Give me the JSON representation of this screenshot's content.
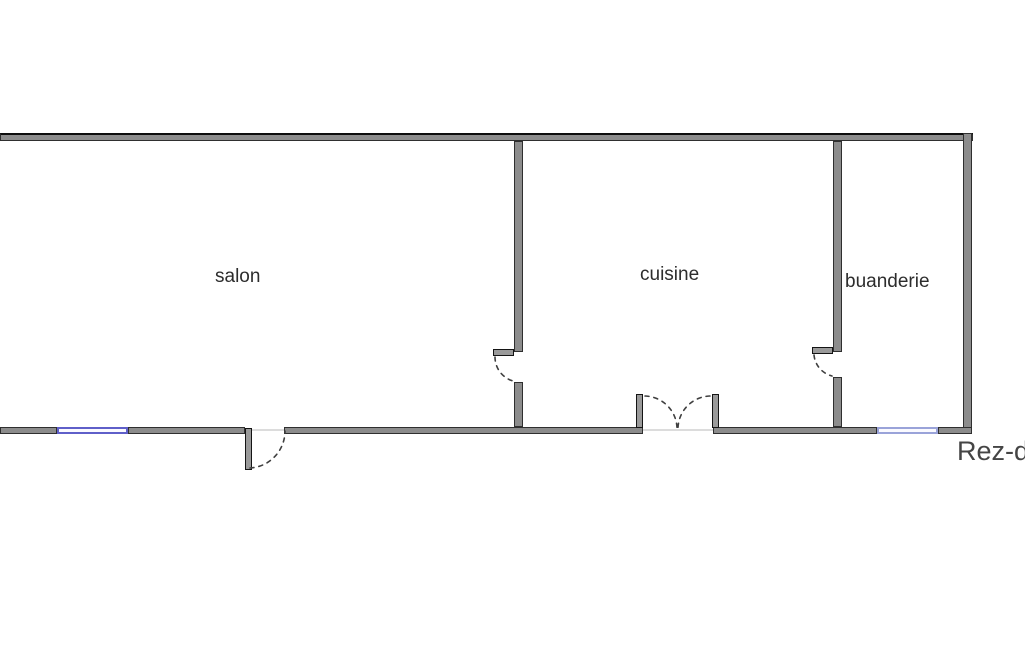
{
  "title": "Floor plan",
  "floor_label": "Rez-d",
  "rooms": [
    {
      "label": "salon"
    },
    {
      "label": "cuisine"
    },
    {
      "label": "buanderie"
    }
  ],
  "features": {
    "windows": [
      {
        "name": "salon-south-window"
      },
      {
        "name": "buanderie-south-window"
      }
    ],
    "doors": [
      {
        "name": "salon-exterior-door",
        "type": "single-swing-out"
      },
      {
        "name": "salon-cuisine-door",
        "type": "single-swing"
      },
      {
        "name": "cuisine-french-door",
        "type": "double-swing"
      },
      {
        "name": "cuisine-buanderie-door",
        "type": "single-swing"
      }
    ]
  },
  "colors": {
    "wall_fill": "#8c8c8c",
    "wall_edge": "#2f2f2f",
    "window_frame": "#5f5fc9",
    "window_frame_light": "#9aa3d9",
    "swing_arc": "#3f3f3f",
    "label_text": "#2d2d2d",
    "floor_label_text": "#454545"
  }
}
